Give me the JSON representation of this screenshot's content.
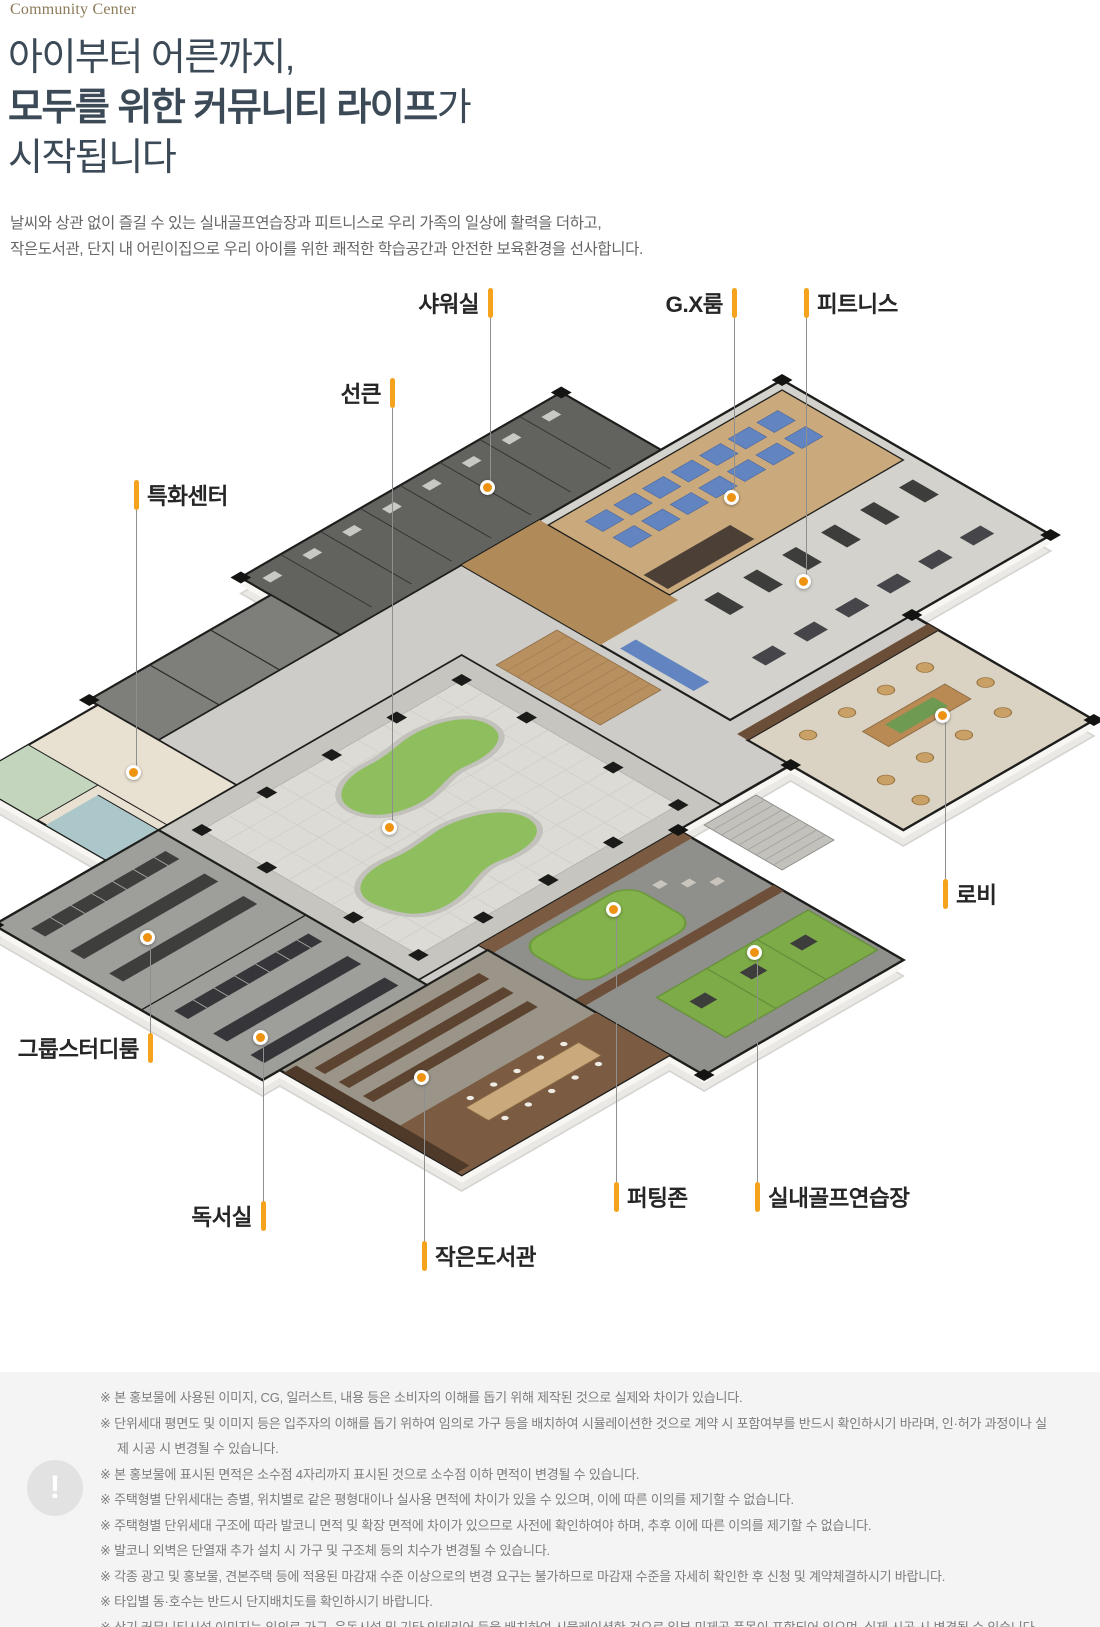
{
  "header": {
    "eyebrow": "Community Center",
    "title_line1": "아이부터 어른까지,",
    "title_line2_bold": "모두를 위한 커뮤니티 라이프",
    "title_line2_suffix": "가",
    "title_line3": "시작됩니다",
    "description_line1": "날씨와 상관 없이 즐길 수 있는 실내골프연습장과 피트니스로 우리 가족의 일상에 활력을 더하고,",
    "description_line2": "작은도서관, 단지 내 어린이집으로 우리 아이를 위한 쾌적한 학습공간과 안전한 보육환경을 선사합니다."
  },
  "colors": {
    "accent": "#f5a31d",
    "dot": "#ee9311",
    "heading": "#3c4a57",
    "eyebrow": "#8c7b59"
  },
  "floorplan": {
    "labels": [
      {
        "id": "shower",
        "text": "샤워실",
        "x": 490,
        "label_y": 303,
        "dot_y": 490,
        "text_side": "left"
      },
      {
        "id": "gx-room",
        "text": "G.X룸",
        "x": 734,
        "label_y": 303,
        "dot_y": 500,
        "text_side": "left"
      },
      {
        "id": "fitness",
        "text": "피트니스",
        "x": 806,
        "label_y": 303,
        "dot_y": 584,
        "text_side": "right"
      },
      {
        "id": "sunken",
        "text": "선큰",
        "x": 392,
        "label_y": 393,
        "dot_y": 830,
        "text_side": "left"
      },
      {
        "id": "special-center",
        "text": "특화센터",
        "x": 136,
        "label_y": 495,
        "dot_y": 775,
        "text_side": "right"
      },
      {
        "id": "lobby",
        "text": "로비",
        "x": 945,
        "label_y": 894,
        "dot_y": 718,
        "text_side": "right"
      },
      {
        "id": "group-study",
        "text": "그룹스터디룸",
        "x": 150,
        "label_y": 1048,
        "dot_y": 940,
        "text_side": "left"
      },
      {
        "id": "reading-room",
        "text": "독서실",
        "x": 263,
        "label_y": 1216,
        "dot_y": 1040,
        "text_side": "left"
      },
      {
        "id": "small-library",
        "text": "작은도서관",
        "x": 424,
        "label_y": 1256,
        "dot_y": 1080,
        "text_side": "right"
      },
      {
        "id": "putting-zone",
        "text": "퍼팅존",
        "x": 616,
        "label_y": 1197,
        "dot_y": 912,
        "text_side": "right"
      },
      {
        "id": "indoor-golf",
        "text": "실내골프연습장",
        "x": 757,
        "label_y": 1197,
        "dot_y": 955,
        "text_side": "right"
      }
    ]
  },
  "disclaimer": {
    "icon": "!",
    "lines": [
      "※ 본 홍보물에 사용된 이미지, CG, 일러스트, 내용 등은 소비자의 이해를 돕기 위해 제작된 것으로 실제와 차이가 있습니다.",
      "※ 단위세대 평면도 및 이미지 등은 입주자의 이해를 돕기 위하여 임의로 가구 등을 배치하여 시뮬레이션한 것으로 계약 시 포함여부를 반드시 확인하시기 바라며, 인·허가 과정이나 실제 시공 시 변경될 수 있습니다.",
      "※ 본 홍보물에 표시된 면적은 소수점 4자리까지 표시된 것으로 소수점 이하 면적이 변경될 수 있습니다.",
      "※ 주택형별 단위세대는 층별, 위치별로 같은 평형대이나 실사용 면적에 차이가 있을 수 있으며, 이에 따른 이의를 제기할 수 없습니다.",
      "※ 주택형별 단위세대 구조에 따라 발코니 면적 및 확장 면적에 차이가 있으므로 사전에 확인하여야 하며, 추후 이에 따른 이의를 제기할 수 없습니다.",
      "※ 발코니 외벽은 단열재 추가 설치 시 가구 및 구조체 등의 치수가 변경될 수 있습니다.",
      "※ 각종 광고 및 홍보물, 견본주택 등에 적용된 마감재 수준 이상으로의 변경 요구는 불가하므로 마감재 수준을 자세히 확인한 후 신청 및 계약체결하시기 바랍니다.",
      "※ 타입별 동·호수는 반드시 단지배치도를 확인하시기 바랍니다.",
      "※ 상기 커뮤니티시설 이미지는 임의로 가구, 운동시설 및 기타 인테리어 등을 배치하여 시뮬레이션한 것으로 일부 미제공 품목이 포함되어 있으며, 실제 시공 시 변경될 수 있습니다"
    ]
  }
}
